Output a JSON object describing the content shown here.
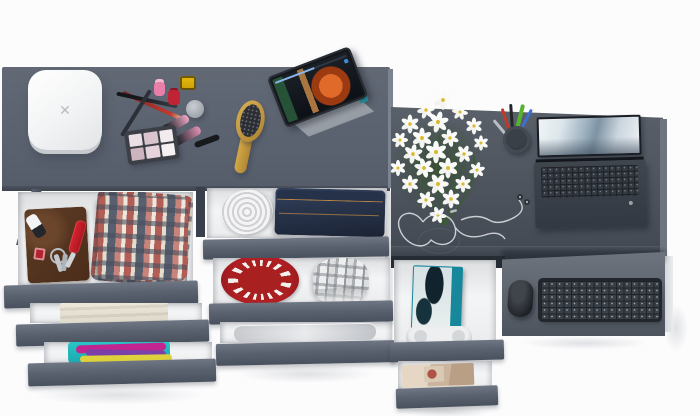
{
  "scene": {
    "label": "Top-down 3D render of a gray dresser and desk combo with open drawers full of clothes and accessories",
    "colors": {
      "background": "#fcfcfd",
      "furniture_gray": "#5a6270",
      "desk_gray": "#4f565f",
      "drawer_interior": "#f2f3f4",
      "accent_teal": "#1b9aa9",
      "accent_red": "#a8201f"
    }
  },
  "items": {
    "charger": {
      "label": "white wireless charger box",
      "glyph": "✕"
    },
    "makeup": {
      "label": "makeup set with pencils, nail polish, palette and lip gloss"
    },
    "palette": {
      "label": "eyeshadow palette"
    },
    "hairbrush": {
      "label": "wooden hair brush"
    },
    "tablet": {
      "label": "tablet on stand playing an animated movie"
    },
    "flowers": {
      "label": "bouquet of white daisies"
    },
    "pen_cup": {
      "label": "pen cup with pens and pencils"
    },
    "earphones": {
      "label": "earphones with cable looped into a heart"
    },
    "laptop": {
      "label": "open laptop with snowy mountain wallpaper"
    },
    "keyboard": {
      "label": "wireless keyboard on pull-out tray"
    },
    "mouse": {
      "label": "wireless mouse"
    },
    "wallet": {
      "label": "brown leather wallet"
    },
    "car_key": {
      "label": "car key fob"
    },
    "pocket_knife": {
      "label": "red pocket knife"
    },
    "keyring": {
      "label": "key ring with keys and red fob"
    },
    "plaid_shirt": {
      "label": "folded red plaid shirts"
    },
    "towel": {
      "label": "folded beige towel"
    },
    "clothes_stack": {
      "label": "stack of colorful folded clothes"
    },
    "belt": {
      "label": "rolled white belt"
    },
    "jeans": {
      "label": "folded blue jeans"
    },
    "beanie": {
      "label": "red knitted hat seen from above"
    },
    "plaid_hat": {
      "label": "gray plaid hat"
    },
    "garment_bag": {
      "label": "translucent folded garment"
    },
    "book": {
      "label": "teal hardcover book"
    },
    "controller": {
      "label": "white game controller"
    },
    "magazines": {
      "label": "stack of magazines"
    }
  }
}
